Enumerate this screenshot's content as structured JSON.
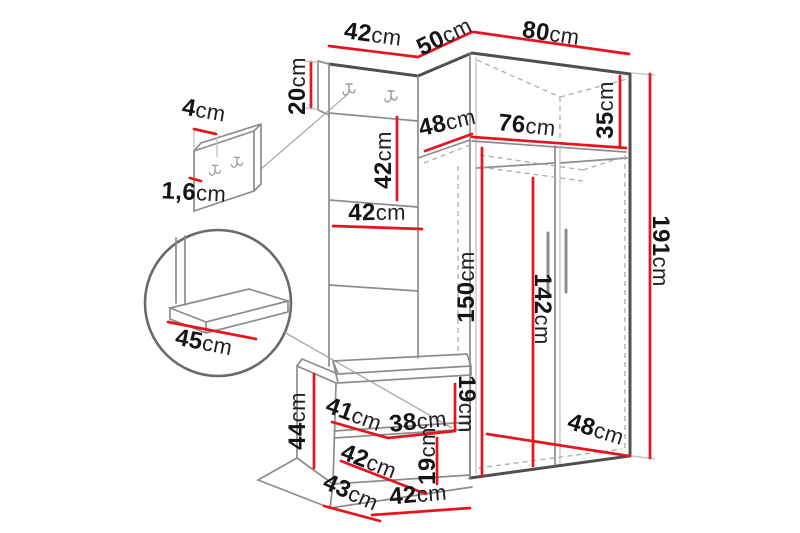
{
  "diagram": {
    "kind": "furniture-dimension-diagram",
    "unit": "cm"
  },
  "colors": {
    "dimension_line": "#e8131b",
    "outline_dark": "#4f4f4f",
    "outline_medium": "#8c8c8c",
    "hidden_line": "#adadad",
    "label_text": "#141414",
    "background": "#ffffff"
  },
  "details": {
    "panel_depth": {
      "v": "4",
      "u": "cm"
    },
    "panel_thickness": {
      "v": "1,6",
      "u": "cm"
    },
    "seat_depth": {
      "v": "45",
      "u": "cm"
    }
  },
  "dims": {
    "top_panel_width": {
      "v": "42",
      "u": "cm"
    },
    "corner_width": {
      "v": "50",
      "u": "cm"
    },
    "wardrobe_width": {
      "v": "80",
      "u": "cm"
    },
    "hook_section_height": {
      "v": "20",
      "u": "cm"
    },
    "panel_section_height": {
      "v": "42",
      "u": "cm"
    },
    "panel_width": {
      "v": "42",
      "u": "cm"
    },
    "top_shelf_depth": {
      "v": "48",
      "u": "cm"
    },
    "top_shelf_width": {
      "v": "76",
      "u": "cm"
    },
    "top_shelf_height": {
      "v": "35",
      "u": "cm"
    },
    "total_height": {
      "v": "191",
      "u": "cm"
    },
    "interior_height": {
      "v": "150",
      "u": "cm"
    },
    "door_height": {
      "v": "142",
      "u": "cm"
    },
    "bench_height": {
      "v": "44",
      "u": "cm"
    },
    "bench_seat_depth": {
      "v": "41",
      "u": "cm"
    },
    "bench_shelf_width": {
      "v": "38",
      "u": "cm"
    },
    "bench_upper_gap": {
      "v": "19",
      "u": "cm"
    },
    "bench_lower_gap": {
      "v": "19",
      "u": "cm"
    },
    "bench_mid_depth": {
      "v": "42",
      "u": "cm"
    },
    "bench_base_depth": {
      "v": "43",
      "u": "cm"
    },
    "bench_width": {
      "v": "42",
      "u": "cm"
    },
    "wardrobe_base_depth": {
      "v": "48",
      "u": "cm"
    }
  }
}
